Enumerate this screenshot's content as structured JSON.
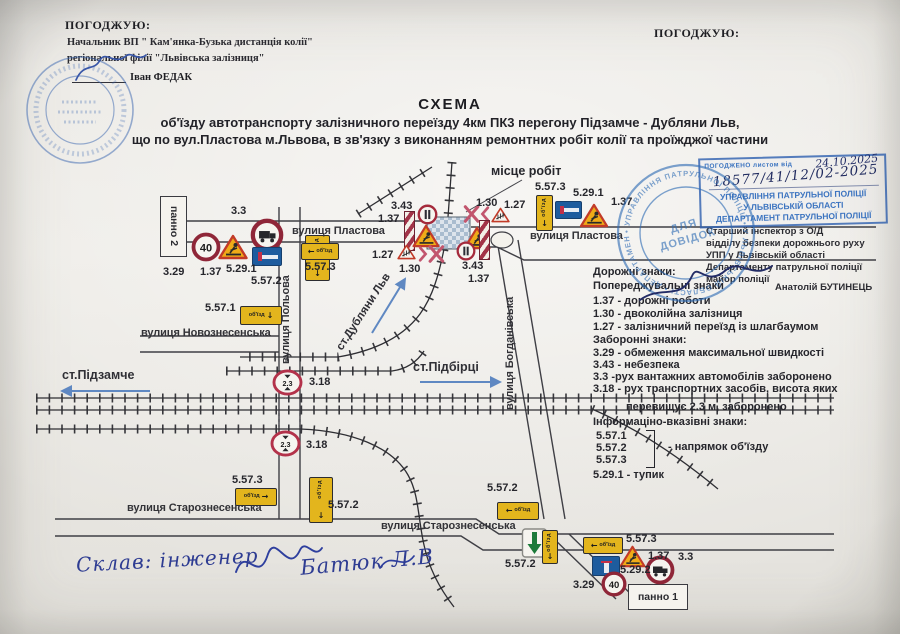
{
  "approval_left": {
    "label": "ПОГОДЖУЮ:",
    "line1": "Начальник ВП \" Кам'янка-Бузька дистанція колії\"",
    "line2": "регіональної філії \"Львівська залізниця\"",
    "name": "Іван ФЕДАК"
  },
  "approval_right": {
    "label": "ПОГОДЖУЮ:"
  },
  "title": {
    "heading": "СХЕМА",
    "line1": "об'їзду автотранспорту  залізничного переїзду 4км ПК3 перегону Підзамче - Дубляни Льв,",
    "line2": "що по вул.Пластова м.Львова,  в  зв'язку  з  виконанням  ремонтних робіт колії та проїжджої частини"
  },
  "rect_stamp": {
    "printed": "ПОГОДЖЕНО листом від",
    "hw_date": "24.10.2025",
    "hw_number": "18577/41/12/02-2025",
    "org1": "УПРАВЛІННЯ ПАТРУЛЬНОЇ ПОЛІЦІЇ",
    "org2": "У ЛЬВІВСЬКІЙ ОБЛАСТІ",
    "org3": "ДЕПАРТАМЕНТ ПАТРУЛЬНОЇ ПОЛІЦІЇ"
  },
  "round_stamp": {
    "ring": "• УПРАВЛІННЯ ПАТРУЛЬНОЇ ПОЛІЦІЇ • У ЛЬВІВСЬКІЙ ОБЛАСТІ • ДЕПАРТАМЕНТ",
    "center1": "ДЛЯ",
    "center2": "ДОВІДОК"
  },
  "inspector": {
    "l1": "Старший інспектор з О/Д",
    "l2": "відділу безпеки дорожнього руху",
    "l3": "УПП у Львівській області",
    "l4": "Департаменту патрульної поліції",
    "l5": "майор поліції",
    "name": "Анатолій БУТИНЕЦЬ"
  },
  "legend": {
    "heading": "Дорожні знаки:",
    "warn_heading": "Попереджувальні знаки",
    "w1": "1.37 - дорожні роботи",
    "w2": "1.30 -  двоколійна  залізниця",
    "w3": "1.27 -  залізничний переїзд із шлагбаумом",
    "ban_heading": "Заборонні знаки:",
    "b1": "3.29 - обмеження максимальної швидкості",
    "b2": "3.43 - небезпека",
    "b3": "3.3 -рух вантажних автомобілів заборонено",
    "b4": "3.18 - рух транспортних засобів, висота яких",
    "b4b": "перевищує 2.3 м, заборонено",
    "info_heading": "Інформаціно-вказівні знаки:",
    "i1": "5.57.1",
    "i2": "5.57.2",
    "i3": "5.57.3",
    "i_note": "- напрямок об'їзду",
    "i4": "5.29.1 - тупик"
  },
  "diagram": {
    "streets": {
      "plastova": "вулиця Пластова",
      "polova": "вулиця Польова",
      "bohdanivska": "вулиця Богданівська",
      "novoznesenska": "вулиця Новознесенська",
      "staroznesenska": "вулиця Старознесенська"
    },
    "stations": {
      "pidzamche": "ст.Підзамче",
      "pidbirtsi": "ст.Підбірці",
      "dublany": "ст.Дубляни Льв"
    },
    "worksite": "місце робіт",
    "panel1": "панно 1",
    "panel2": "панно 2"
  },
  "codes": {
    "c137": "1.37",
    "c130": "1.30",
    "c127": "1.27",
    "c329": "3.29",
    "c343": "3.43",
    "c33": "3.3",
    "c318": "3.18",
    "c5571": "5.57.1",
    "c5572": "5.57.2",
    "c5573": "5.57.3",
    "c5291": "5.29.1",
    "c5292": "5.29.2"
  },
  "sign_text": {
    "speed": "40",
    "height": "2.3",
    "detour": "об'їзд"
  },
  "composer": {
    "prefix": "Склав:  інженер",
    "name": "Батюк Л.В"
  }
}
